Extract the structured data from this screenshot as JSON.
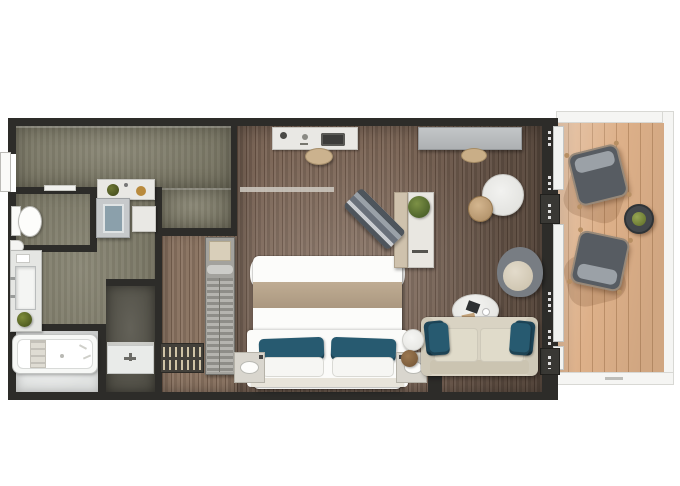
{
  "app": {
    "name": "suite-floor-plan",
    "description": "Top-down architectural floor plan of a suite with balcony"
  },
  "palette": {
    "wall": "#2d2c29",
    "wood_floor": "#7c6657",
    "hallway_floor": "#7b7864",
    "closet_floor": "#8a7361",
    "shower_floor": "#56544a",
    "bath_tile": "#e0e2e1",
    "deck": "#ddb089",
    "railing": "#f5f5f3",
    "accent_pillow_teal": "#275a70",
    "sofa_beige": "#d9d3c3",
    "bed_runner_beige": "#b5a28b",
    "greenery": "#55631f",
    "stool_tan": "#c9ae87",
    "lounge_chair_gray": "#575c62"
  },
  "rooms": [
    {
      "id": "entry-hallway",
      "label": "Entry hallway"
    },
    {
      "id": "wc",
      "label": "Toilet room"
    },
    {
      "id": "bathroom",
      "label": "Bathroom"
    },
    {
      "id": "shower-room",
      "label": "Shower room"
    },
    {
      "id": "walk-in-closet",
      "label": "Walk-in closet"
    },
    {
      "id": "bedroom",
      "label": "Bedroom"
    },
    {
      "id": "living-area",
      "label": "Living area"
    },
    {
      "id": "balcony",
      "label": "Balcony"
    }
  ],
  "furniture": {
    "toilet": "Toilet",
    "vanity": "Vanity with washbasin",
    "bathtub": "Bathtub",
    "shower": "Walk-in shower",
    "shower_stall": "Shower stall",
    "wardrobe": "Wardrobe with hangers",
    "shelf_tower": "Shelf tower",
    "bed": "Double bed",
    "nightstand_left": "Nightstand with lamp",
    "nightstand_right": "Nightstand with lamp",
    "desk_top": "Dressing desk",
    "desk_stool": "Stool",
    "console": "Console cabinet",
    "console_stool": "Stool",
    "side_desk": "Writing desk with plant",
    "bench": "Upholstered bench",
    "dining_table": "Round table",
    "dining_stool": "Stool",
    "armchair": "Armchair",
    "coffee_table": "Oval coffee table",
    "sofa": "Sofa with pillows",
    "side_table": "Side table",
    "side_stool": "Pouf",
    "lounge_chair_1": "Deck lounge chair",
    "lounge_chair_2": "Deck lounge chair",
    "balcony_table": "Balcony table with plant",
    "entry_door": "Entrance door"
  }
}
